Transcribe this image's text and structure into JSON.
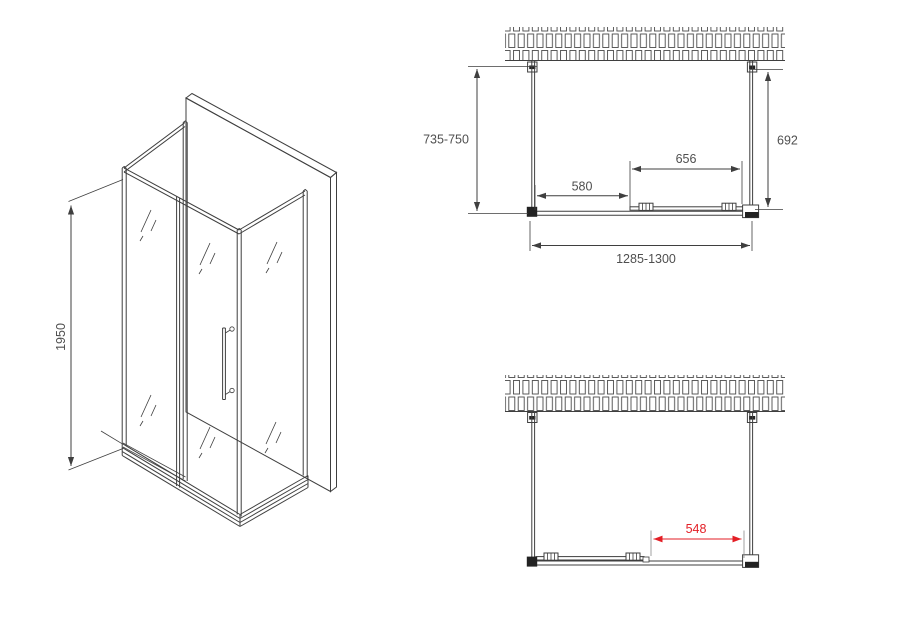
{
  "drawing": {
    "iso_view": {
      "height_label": "1950"
    },
    "plan_view_closed": {
      "depth_label": "735-750",
      "inner_depth_label": "692",
      "door_width_label": "656",
      "fixed_panel_label": "580",
      "total_width_label": "1285-1300"
    },
    "plan_view_open": {
      "opening_width_label": "548"
    }
  },
  "colors": {
    "line": "#3f3f3f",
    "dimension_text": "#4f4f4f",
    "accent_red": "#e31e25",
    "background": "#ffffff"
  }
}
